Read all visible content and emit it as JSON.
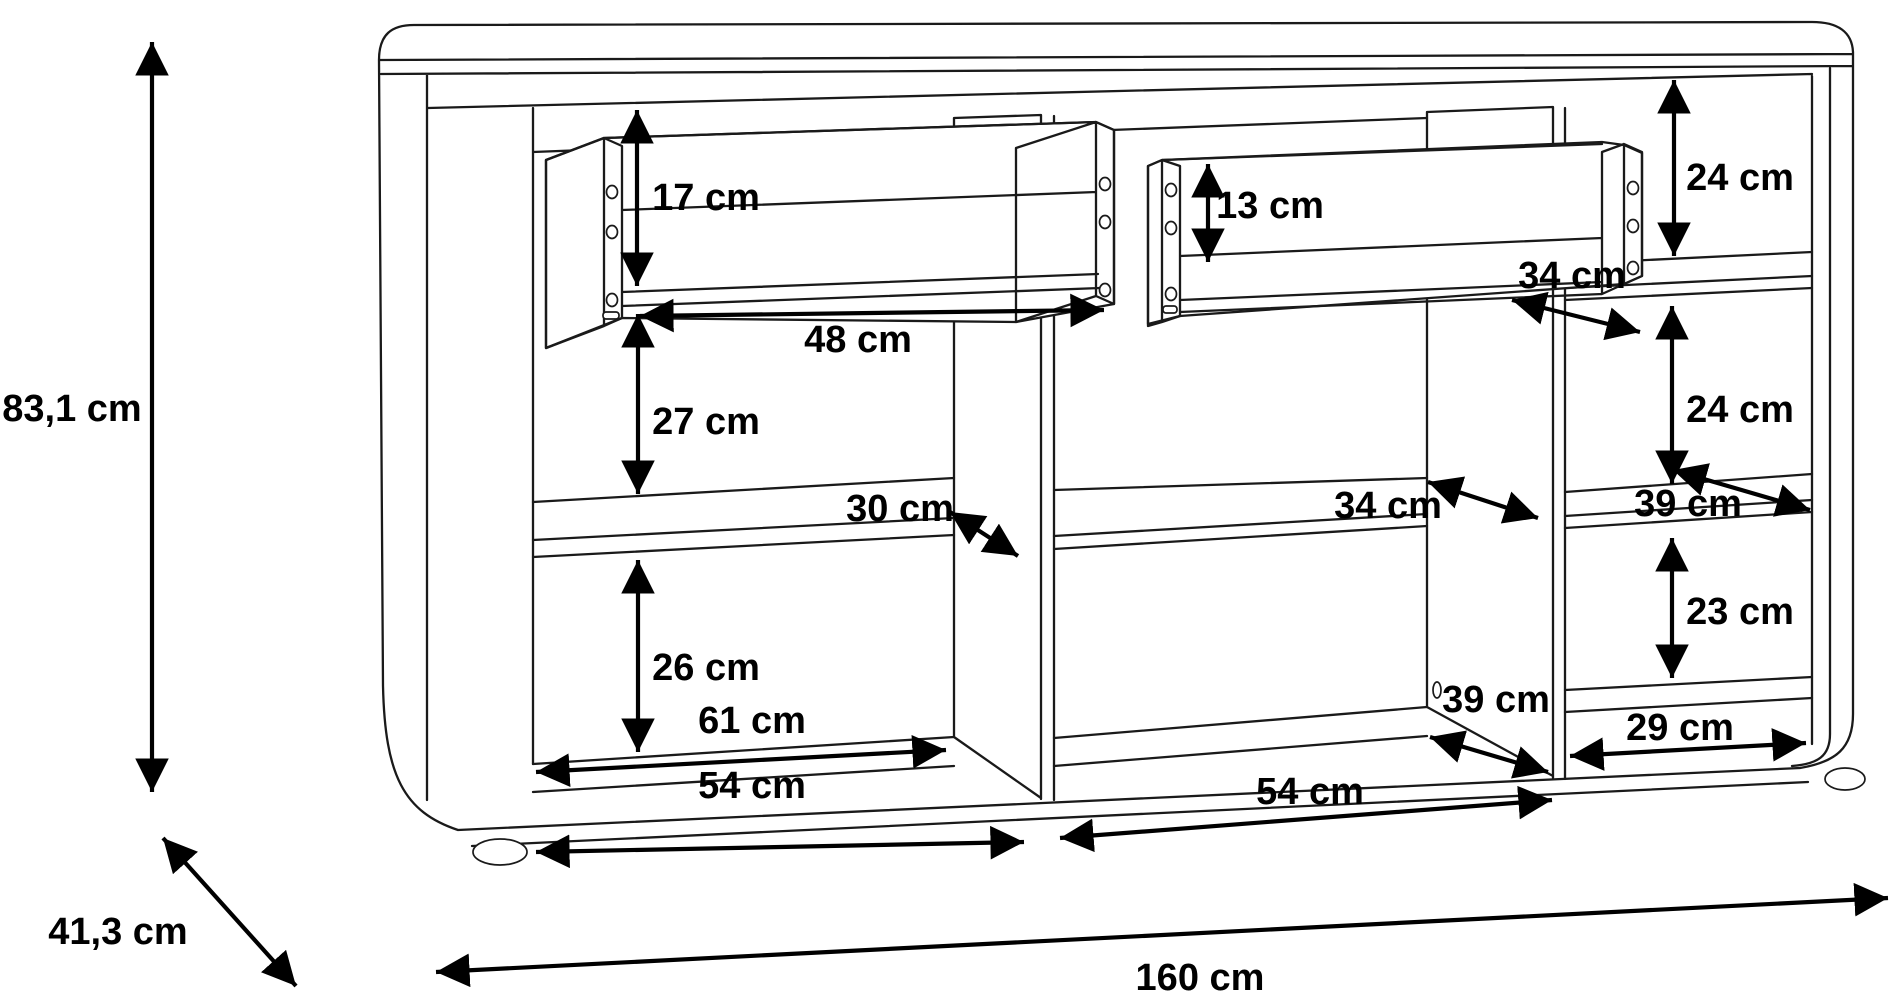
{
  "diagram": {
    "title": "Sideboard dimension drawing",
    "unit": "cm",
    "overall": {
      "height": "83,1 cm",
      "depth": "41,3 cm",
      "width": "160 cm"
    },
    "dims": {
      "drawer_left_height": "17 cm",
      "drawer_left_width": "48 cm",
      "left_gap_upper": "27 cm",
      "left_shelf_depth": "30 cm",
      "left_gap_lower": "26 cm",
      "left_width_back": "61 cm",
      "left_width_front": "54 cm",
      "drawer_mid_height": "13 cm",
      "drawer_mid_depth": "34 cm",
      "mid_shelf_depth": "34 cm",
      "mid_floor_depth": "39 cm",
      "mid_width": "54 cm",
      "right_top_height": "24 cm",
      "right_mid_height": "24 cm",
      "right_shelf_depth": "39 cm",
      "right_lower_height": "23 cm",
      "right_width": "29 cm"
    }
  }
}
